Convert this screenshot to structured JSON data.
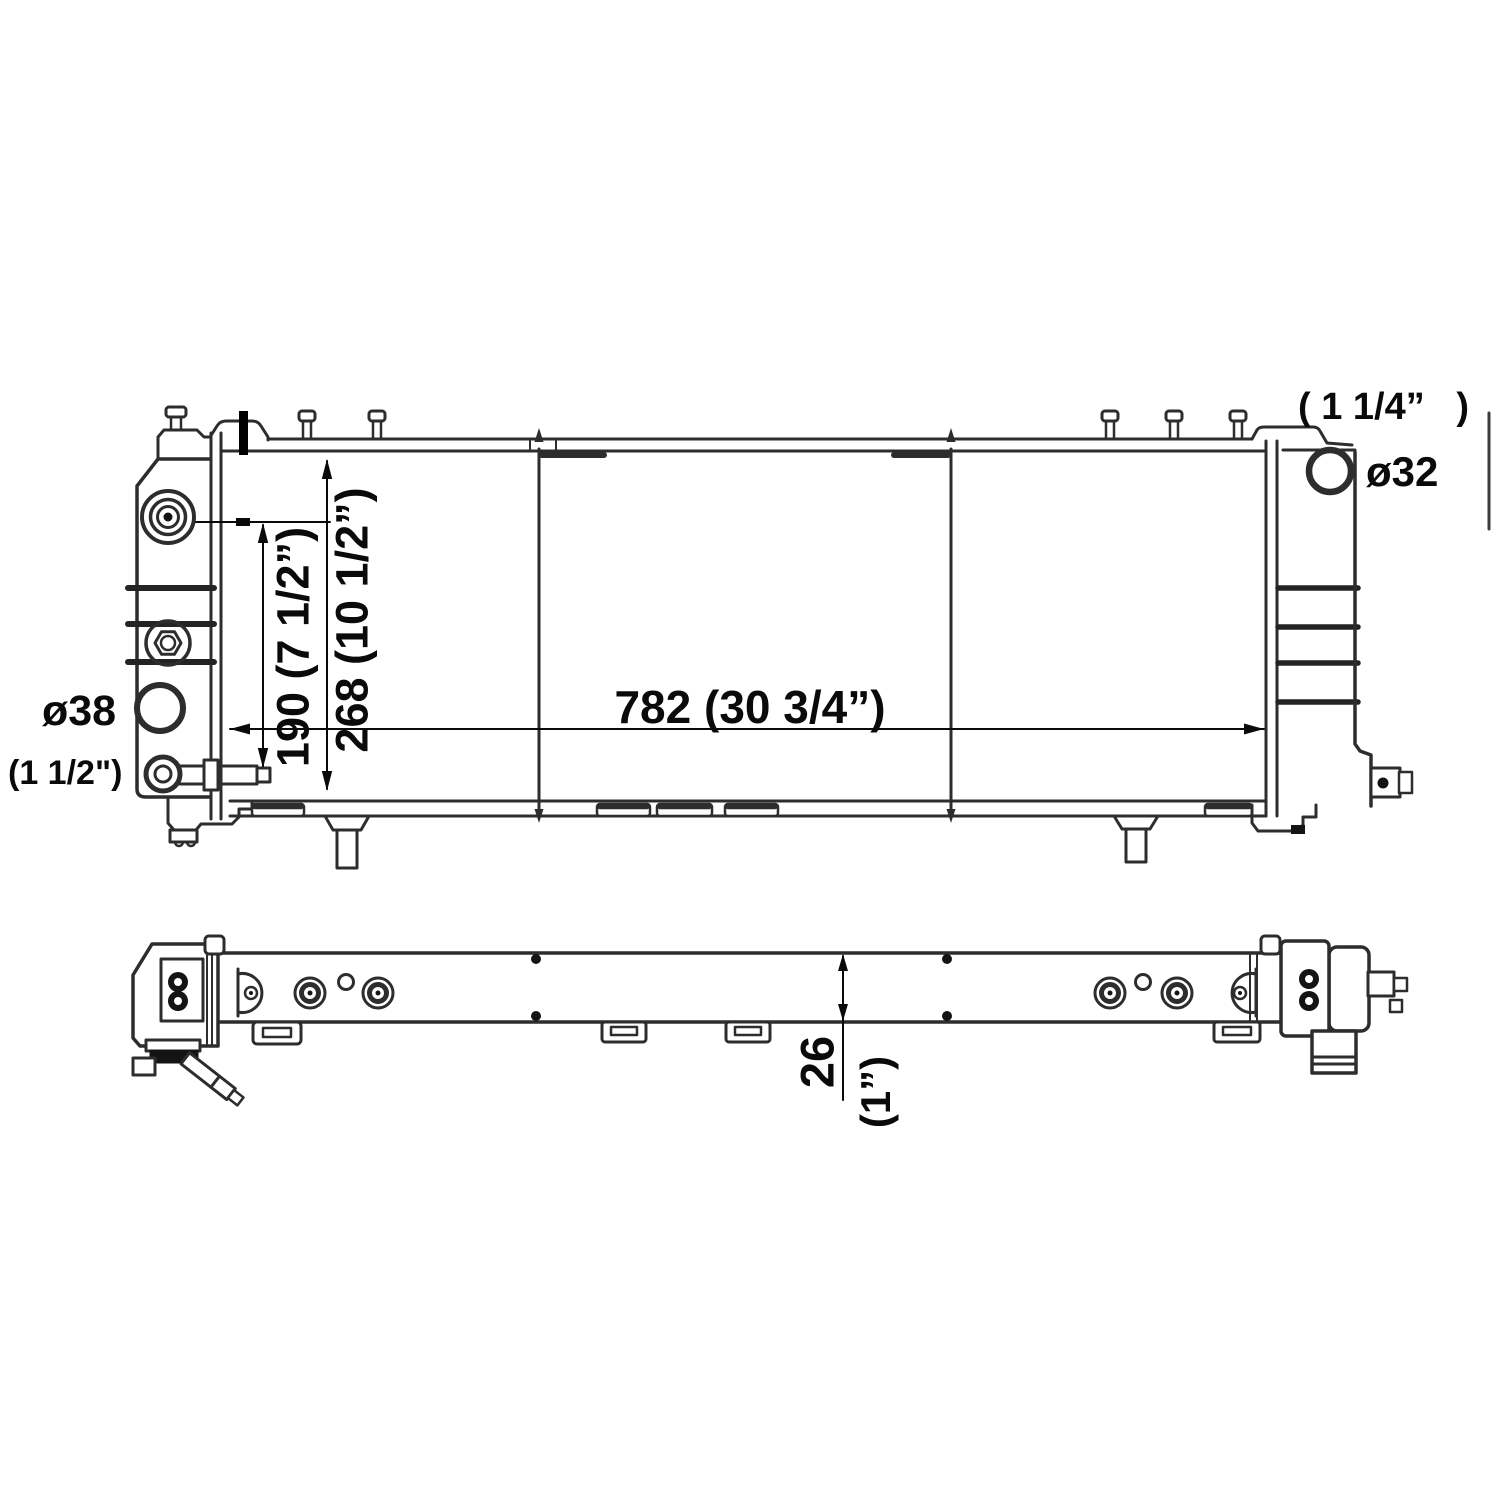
{
  "page": {
    "background": "#ffffff"
  },
  "colors": {
    "line": "#2d2d2d",
    "text": "#0a0a0a",
    "fill_dark": "#141414"
  },
  "dimensions": {
    "core_width": "782 (30 3/4”)",
    "port_spacing": "190 (7 1/2”)",
    "core_height": "268 (10 1/2”)",
    "right_port_diameter": "ø32",
    "right_port_hose": "( 1 1/4”   )",
    "left_port_diameter": "ø38",
    "left_port_hose": "(1 1/2\")",
    "core_thickness": "26",
    "core_thickness_inches": "(1”)"
  }
}
